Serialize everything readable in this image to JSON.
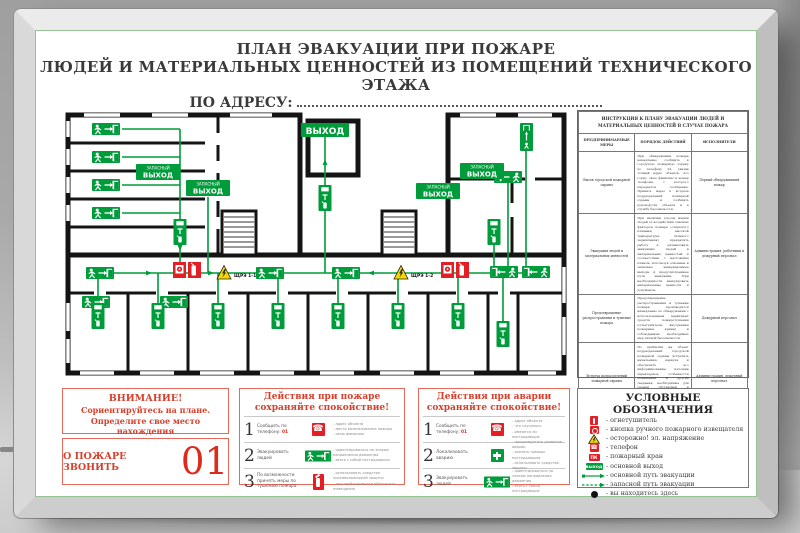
{
  "poster": {
    "title_line1": "ПЛАН ЭВАКУАЦИИ ПРИ ПОЖАРЕ",
    "title_line2": "ЛЮДЕЙ И МАТЕРИАЛЬНЫХ ЦЕННОСТЕЙ ИЗ ПОМЕЩЕНИЙ ТЕХНИЧЕСКОГО ЭТАЖА",
    "address_label": "ПО АДРЕСУ:"
  },
  "plan": {
    "exit_label": "ВЫХОД",
    "emexit_l1": "ЗАПАСНЫЙ",
    "emexit_l2": "ВЫХОД",
    "panel1": "ЩРЭ 1-1",
    "panel2": "ЩРЭ 1-2"
  },
  "itable": {
    "title": "ИНСТРУКЦИЯ К ПЛАНУ ЭВАКУАЦИИ ЛЮДЕЙ И МАТЕРИАЛЬНЫХ ЦЕННОСТЕЙ В СЛУЧАЕ ПОЖАРА",
    "columns": [
      "ПРЕДПРИНИМАЕМЫЕ МЕРЫ",
      "ПОРЯДОК ДЕЙСТВИЙ",
      "ИСПОЛНИТЕЛИ"
    ],
    "rows": [
      {
        "measure": "Вызов городской пожарной охраны",
        "actions": "При обнаружении пожара немедленно сообщить в городскую пожарную охрану по телефону 01, указав точный адрес объекта, что горит, свою фамилию и номер телефона, с которого передается сообщение. Принять меры к встрече подразделений пожарной охраны и сообщить руководству объекта и в службу безопасности.",
        "executor": "Первый обнаруживший пожар"
      },
      {
        "measure": "Эвакуация людей и материальных ценностей",
        "actions": "При наличии угрозы жизни людей от воздействия опасных факторов пожара (открытого пламени, высокой температуры, сильного задымления) прекратить работу и организовать эвакуацию людей и материальных ценностей в соответствии с настоящим планом, используя основные и запасные эвакуационные выходы и предусмотренные пути эвакуации. При необходимости эвакуировать материальные ценности и документы.",
        "executor": "Администрация, работники и дежурный персонал"
      },
      {
        "measure": "Предотвращение распространения и тушение пожара",
        "actions": "Предотвращение распространения и тушение пожара производится немедленно по обнаружении с использованием первичных средств пожаротушения (огнетушители, внутренние пожарные краны) и соблюдением необходимых мер личной безопасности.",
        "executor": "Дежурный персонал"
      },
      {
        "measure": "Встреча подразделений пожарной охраны",
        "actions": "По прибытии на объект подразделений городской пожарной охраны встретить начальника караула и обеспечить его информирование, изложив характерные особенности помещений и другие сведения, необходимые для оценки обстановки и проведения работ на объекте (место пожара, расположение подъездных путей и водоисточников, документация и т.п.).",
        "executor": "Администрация, дежурный персонал"
      }
    ]
  },
  "attention": {
    "line1": "ВНИМАНИЕ!",
    "line2": "Сориентируйтесь на плане.",
    "line3": "Определите свое место нахождения"
  },
  "call": {
    "label": "О ПОЖАРЕ ЗВОНИТЬ",
    "number": "01"
  },
  "fire": {
    "title1": "Действия при пожаре",
    "title2": "сохраняйте спокойствие!",
    "steps": [
      {
        "num": "1",
        "label": "Сообщить по телефону:",
        "number": "01",
        "bullets": [
          "- адрес объекта",
          "- место возникновения пожара",
          "- свою фамилию"
        ]
      },
      {
        "num": "2",
        "label": "Эвакуировать людей",
        "number": "",
        "bullets": [
          "- ориентироваться по знакам направления движения",
          "- взять с собой пострадавших"
        ]
      },
      {
        "num": "3",
        "label": "По возможности принять меры по тушению пожара",
        "number": "",
        "bullets": [
          "- использовать средства противопожарной защиты",
          "- при необходимости обесточить помещение"
        ]
      }
    ]
  },
  "acc": {
    "title1": "Действия при аварии",
    "title2": "сохраняйте спокойствие!",
    "steps": [
      {
        "num": "1",
        "label": "Сообщить по телефону:",
        "number": "01",
        "bullets": [
          "- адрес объекта",
          "- что случилось",
          "- имеются ли пострадавшие"
        ]
      },
      {
        "num": "2",
        "label": "Локализовать аварию",
        "number": "",
        "bullets": [
          "- предотвратить развитие аварии",
          "- оказать помощь пострадавшим",
          "- использовать средства защиты"
        ]
      },
      {
        "num": "3",
        "label": "Эвакуировать людей",
        "number": "",
        "bullets": [
          "- ориентироваться по знакам направления движения",
          "- взять с собой пострадавших"
        ]
      }
    ]
  },
  "legend": {
    "title": "УСЛОВНЫЕ ОБОЗНАЧЕНИЯ",
    "items": [
      {
        "icon": "extinguisher-icon",
        "label": "- огнетушитель"
      },
      {
        "icon": "alarm-button-icon",
        "label": "- кнопка ручного пожарного извещателя"
      },
      {
        "icon": "electric-warning-icon",
        "label": "- осторожно! эл. напряжение"
      },
      {
        "icon": "phone-icon",
        "label": "- телефон"
      },
      {
        "icon": "fire-hydrant-icon",
        "label": "- пожарный кран",
        "icon_text": "ПК"
      },
      {
        "icon": "main-exit-icon",
        "label": "- основной выход",
        "icon_text": "ВЫХОД"
      },
      {
        "icon": "main-route-icon",
        "label": "- основной путь эвакуации"
      },
      {
        "icon": "reserve-route-icon",
        "label": "- запасной путь эвакуации"
      },
      {
        "icon": "you-are-here-icon",
        "label": "- вы находитесь здесь"
      }
    ]
  },
  "colors": {
    "green": "#009b3a",
    "red": "#e31e24",
    "border_red": "#e8695a",
    "yellow": "#f6d800"
  }
}
